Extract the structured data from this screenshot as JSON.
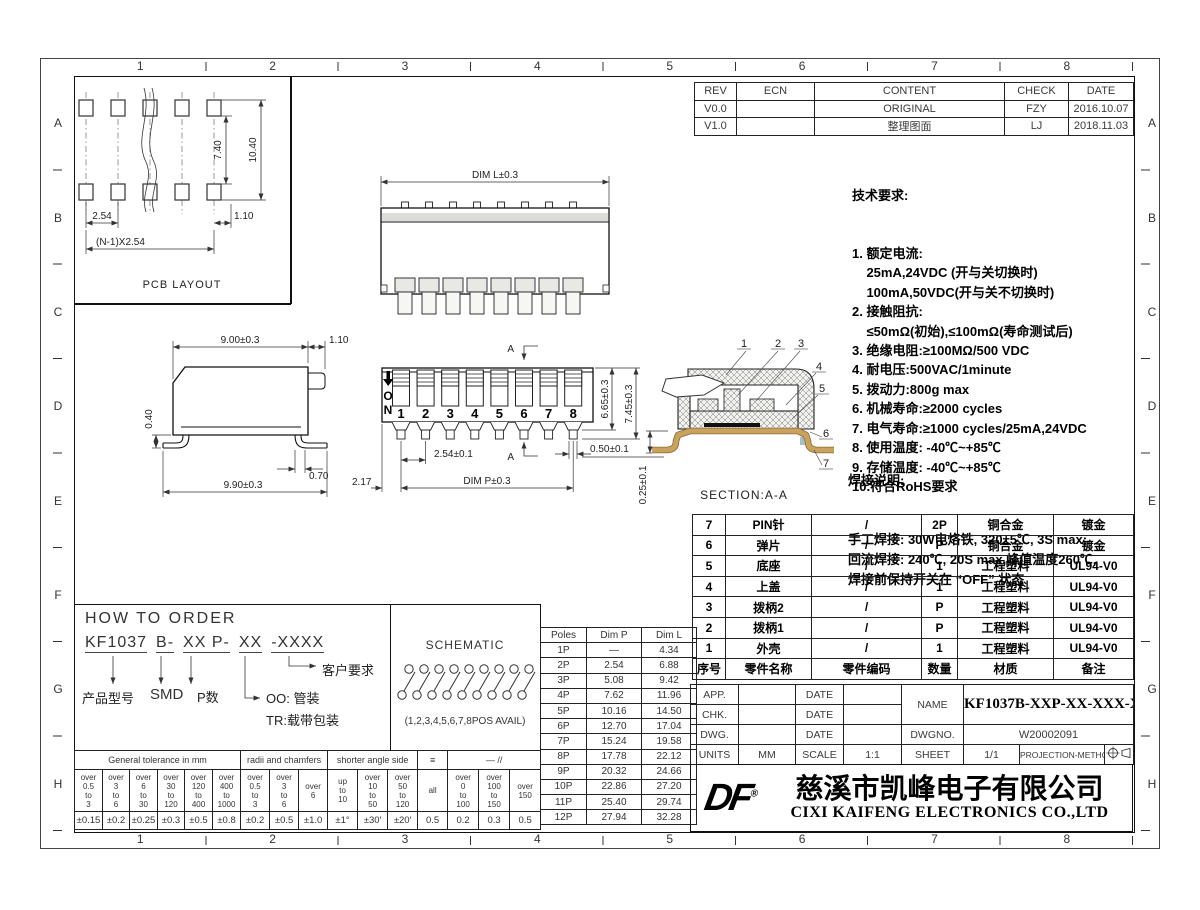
{
  "grid": {
    "cols": [
      "1",
      "2",
      "3",
      "4",
      "5",
      "6",
      "7",
      "8"
    ],
    "rows": [
      "A",
      "B",
      "C",
      "D",
      "E",
      "F",
      "G",
      "H"
    ]
  },
  "revision_table": {
    "headers": [
      "REV",
      "ECN",
      "CONTENT",
      "CHECK",
      "DATE"
    ],
    "rows": [
      [
        "V0.0",
        "",
        "ORIGINAL",
        "FZY",
        "2016.10.07"
      ],
      [
        "V1.0",
        "",
        "整理图面",
        "LJ",
        "2018.11.03"
      ]
    ]
  },
  "tech": {
    "title": "技术要求:",
    "lines": [
      "1. 额定电流:",
      "    25mA,24VDC (开与关切换时)",
      "    100mA,50VDC(开与关不切换时)",
      "2. 接触阻抗:",
      "    ≤50mΩ(初始),≤100mΩ(寿命测试后)",
      "3. 绝缘电阻:≥100MΩ/500 VDC",
      "4. 耐电压:500VAC/1minute",
      "5. 拨动力:800g max",
      "6. 机械寿命:≥2000 cycles",
      "7. 电气寿命:≥1000 cycles/25mA,24VDC",
      "8. 使用温度: -40℃~+85℃",
      "9. 存储温度: -40℃~+85℃",
      "10.符合RoHS要求"
    ]
  },
  "solder": {
    "title": "焊接说明:",
    "lines": [
      "手工焊接: 30W电烙铁, 320±5℃, 3S max;",
      "回流焊接: 240℃, 20S max,峰值温度260℃,",
      "焊接前保持开关在 “OFF” 状态"
    ]
  },
  "bom": {
    "headers": [
      "序号",
      "零件名称",
      "零件编码",
      "数量",
      "材质",
      "备注"
    ],
    "rows": [
      [
        "7",
        "PIN针",
        "/",
        "2P",
        "铜合金",
        "镀金"
      ],
      [
        "6",
        "弹片",
        "/",
        "P",
        "铜合金",
        "镀金"
      ],
      [
        "5",
        "底座",
        "/",
        "1",
        "工程塑料",
        "UL94-V0"
      ],
      [
        "4",
        "上盖",
        "/",
        "1",
        "工程塑料",
        "UL94-V0"
      ],
      [
        "3",
        "拨柄2",
        "/",
        "P",
        "工程塑料",
        "UL94-V0"
      ],
      [
        "2",
        "拨柄1",
        "/",
        "P",
        "工程塑料",
        "UL94-V0"
      ],
      [
        "1",
        "外壳",
        "/",
        "1",
        "工程塑料",
        "UL94-V0"
      ]
    ]
  },
  "title_block": {
    "app": "APP.",
    "chk": "CHK.",
    "dwg": "DWG.",
    "units": "UNITS",
    "date": "DATE",
    "units_value": "MM",
    "scale": "SCALE",
    "scale_value": "1:1",
    "name": "NAME",
    "name_value": "KF1037B-XXP-XX-XXX-XXX",
    "dwgno": "DWGNO.",
    "dwgno_value": "W20002091",
    "sheet": "SHEET",
    "sheet_value": "1/1",
    "projection": "PROJECTION-METHOD"
  },
  "company": {
    "logo": "DF",
    "reg": "®",
    "name_cn": "慈溪市凯峰电子有限公司",
    "name_en": "CIXI KAIFENG ELECTRONICS CO.,LTD"
  },
  "order": {
    "title": "HOW TO ORDER",
    "code_parts": [
      "KF1037",
      "B-",
      "XX P-",
      "XX",
      "-XXXX"
    ],
    "labels": {
      "model": "产品型号",
      "smd": "SMD",
      "pnum": "P数",
      "tube": "OO: 管装",
      "tr": "TR:载带包装",
      "custom": "客户要求"
    }
  },
  "schematic": {
    "title": "SCHEMATIC",
    "caption": "(1,2,3,4,5,6,7,8POS AVAIL)"
  },
  "poles_table": {
    "headers": [
      "Poles",
      "Dim P",
      "Dim L"
    ],
    "rows": [
      [
        "1P",
        "—",
        "4.34"
      ],
      [
        "2P",
        "2.54",
        "6.88"
      ],
      [
        "3P",
        "5.08",
        "9.42"
      ],
      [
        "4P",
        "7.62",
        "11.96"
      ],
      [
        "5P",
        "10.16",
        "14.50"
      ],
      [
        "6P",
        "12.70",
        "17.04"
      ],
      [
        "7P",
        "15.24",
        "19.58"
      ],
      [
        "8P",
        "17.78",
        "22.12"
      ],
      [
        "9P",
        "20.32",
        "24.66"
      ],
      [
        "10P",
        "22.86",
        "27.20"
      ],
      [
        "11P",
        "25.40",
        "29.74"
      ],
      [
        "12P",
        "27.94",
        "32.28"
      ]
    ]
  },
  "tolerance": {
    "groups": [
      "General tolerance in mm",
      "radii and chamfers",
      "shorter angle side",
      "≡",
      "— //"
    ],
    "sub": [
      "over\n0.5\nto\n3",
      "over\n3\nto\n6",
      "over\n6\nto\n30",
      "over\n30\nto\n120",
      "over\n120\nto\n400",
      "over\n400\nto\n1000",
      "over\n0.5\nto\n3",
      "over\n3\nto\n6",
      "over\n6",
      "up\nto\n10",
      "over\n10\nto\n50",
      "over\n50\nto\n120",
      "all",
      "over\n0\nto\n100",
      "over\n100\nto\n150",
      "over\n150"
    ],
    "values": [
      "±0.15",
      "±0.2",
      "±0.25",
      "±0.3",
      "±0.5",
      "±0.8",
      "±0.2",
      "±0.5",
      "±1.0",
      "±1°",
      "±30′",
      "±20′",
      "0.5",
      "0.2",
      "0.3",
      "0.5"
    ]
  },
  "views": {
    "pcb": {
      "label": "PCB LAYOUT",
      "dim_v1": "7.40",
      "dim_v2": "10.40",
      "dim_pitch": "2.54",
      "dim_offset": "1.10",
      "dim_total": "(N-1)X2.54"
    },
    "top": {
      "dim_l": "DIM L±0.3"
    },
    "side": {
      "dim_w": "9.00±0.3",
      "dim_nub": "1.10",
      "dim_gap": "0.40",
      "dim_leg": "0.70",
      "dim_total": "9.90±0.3"
    },
    "front": {
      "on_o": "O",
      "on_n": "N",
      "numbers": [
        "1",
        "2",
        "3",
        "4",
        "5",
        "6",
        "7",
        "8"
      ],
      "dim_h1": "6.65±0.3",
      "dim_h2": "7.45±0.3",
      "dim_pitch": "2.54±0.1",
      "dim_p": "DIM P±0.3",
      "dim_pin": "0.50±0.1",
      "dim_edge": "2.17",
      "section": "A"
    },
    "section": {
      "label": "SECTION:A-A",
      "dim": "0.25±0.1",
      "callouts": [
        "1",
        "2",
        "3",
        "4",
        "5",
        "6",
        "7"
      ]
    }
  }
}
